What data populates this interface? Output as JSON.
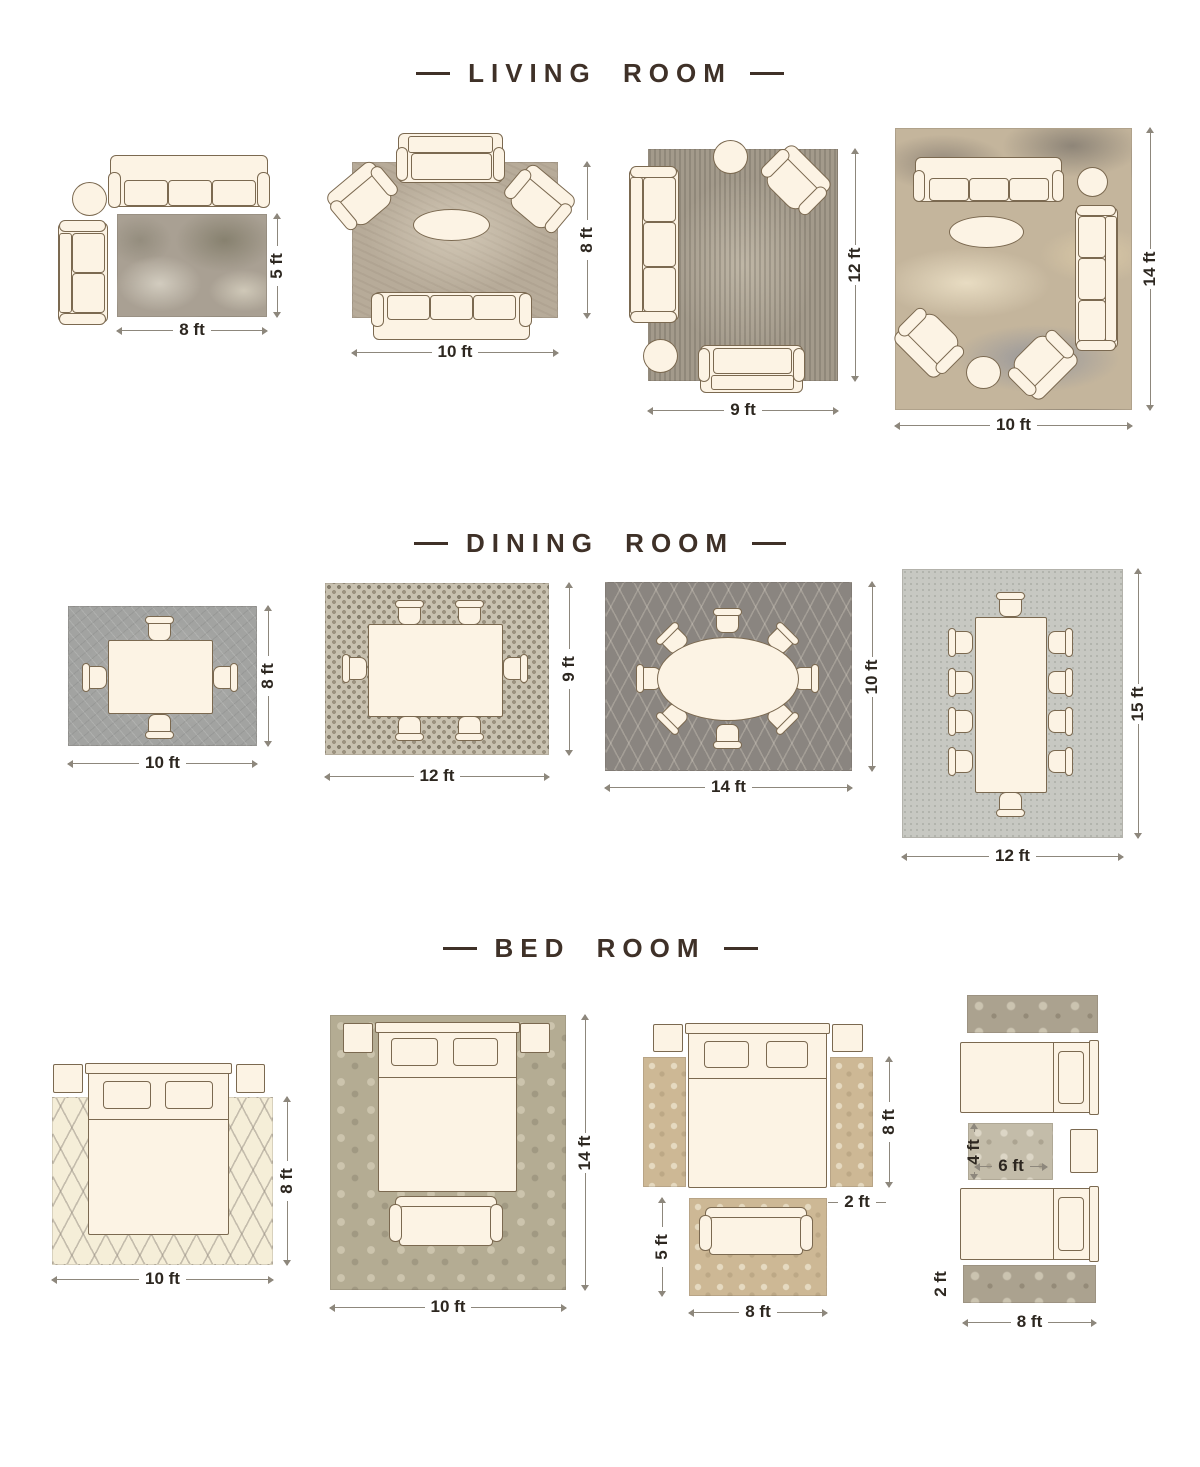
{
  "colors": {
    "background": "#ffffff",
    "title_text": "#3f3128",
    "dimension_text": "#2d2720",
    "furniture_fill": "#fcf3e4",
    "furniture_outline": "#7b6950",
    "dimension_line": "#8d877c"
  },
  "sections": [
    {
      "title": "LIVING ROOM",
      "layouts": [
        {
          "id": "living-1",
          "rug_width": "8 ft",
          "rug_height": "5 ft"
        },
        {
          "id": "living-2",
          "rug_width": "10 ft",
          "rug_height": "8 ft"
        },
        {
          "id": "living-3",
          "rug_width": "9 ft",
          "rug_height": "12 ft"
        },
        {
          "id": "living-4",
          "rug_width": "10 ft",
          "rug_height": "14 ft"
        }
      ]
    },
    {
      "title": "DINING ROOM",
      "layouts": [
        {
          "id": "dining-1",
          "rug_width": "10 ft",
          "rug_height": "8 ft"
        },
        {
          "id": "dining-2",
          "rug_width": "12 ft",
          "rug_height": "9 ft"
        },
        {
          "id": "dining-3",
          "rug_width": "14 ft",
          "rug_height": "10 ft"
        },
        {
          "id": "dining-4",
          "rug_width": "12 ft",
          "rug_height": "15 ft"
        }
      ]
    },
    {
      "title": "BED ROOM",
      "layouts": [
        {
          "id": "bed-1",
          "rug_width": "10 ft",
          "rug_height": "8 ft"
        },
        {
          "id": "bed-2",
          "rug_width": "10 ft",
          "rug_height": "14 ft"
        },
        {
          "id": "bed-3",
          "rug_width": "8 ft",
          "rug_height": "5 ft",
          "runner_height": "8 ft",
          "runner_width": "2 ft"
        },
        {
          "id": "bed-4",
          "runner_width": "8 ft",
          "runner_height": "2 ft",
          "center_rug_width": "6 ft",
          "center_rug_height": "4 ft"
        }
      ]
    }
  ]
}
